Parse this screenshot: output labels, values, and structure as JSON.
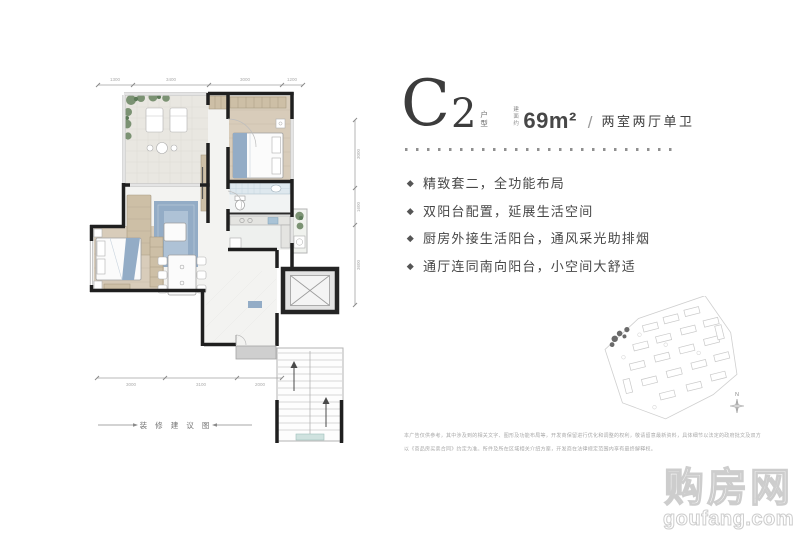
{
  "header": {
    "type_letter": "C",
    "type_number": "2",
    "type_suffix": "户型",
    "area_label": "建面约",
    "area_value": "69m²",
    "divider": "/",
    "rooms": "两室两厅单卫"
  },
  "highlights": [
    "精致套二，全功能布局",
    "双阳台配置，延展生活空间",
    "厨房外接生活阳台，通风采光助排烟",
    "通厅连同南向阳台，小空间大舒适"
  ],
  "floorplan": {
    "caption": "装 修 建 议 图",
    "dims": {
      "top": [
        "1300",
        "3400",
        "3000",
        "1200"
      ],
      "bottom": [
        "3000",
        "3100",
        "2000"
      ],
      "right": [
        "3000",
        "1600",
        "3600"
      ]
    }
  },
  "siteplan": {
    "compass": "N"
  },
  "disclaimer": {
    "line1": "本广告仅供参考，其中涉及到的相关文字、图形及功能布局等，开发商保留进行优化和调整的权利，敬请留意最新资料，具体细节以法定的政府批文及双方",
    "line2": "以《商品房买卖合同》约定为准。所件及所在区域相关介绍方案，开发商在法律规定范围内享有最终解释权。"
  },
  "watermark": {
    "title": "购房网",
    "domain": "goufang.com"
  },
  "colors": {
    "accent_blue": "#93acc6",
    "wood": "#cdbfa6",
    "plant_green": "#7b9273",
    "wall": "#1f1f1f"
  }
}
